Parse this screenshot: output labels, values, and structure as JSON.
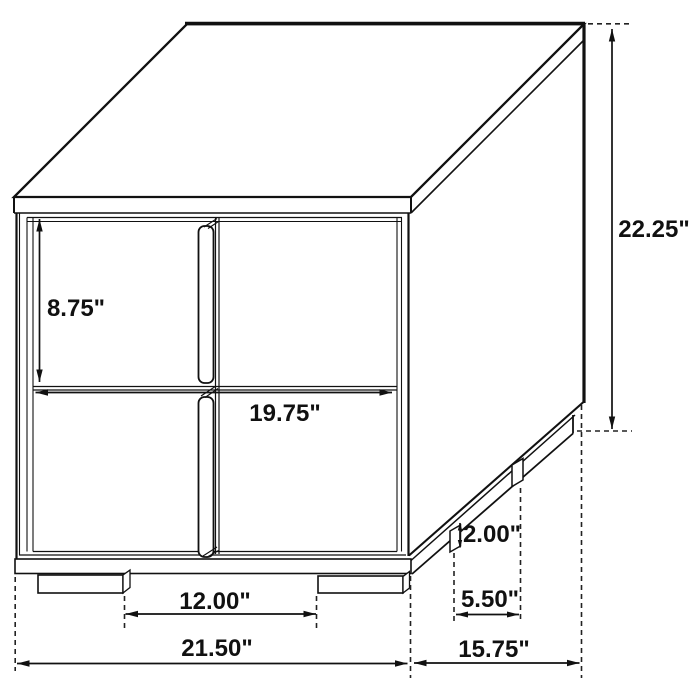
{
  "figure": {
    "type": "furniture-dimension-diagram",
    "item": "two-drawer nightstand line drawing",
    "units": "inches",
    "line_color": "#111111",
    "background_color": "#ffffff"
  },
  "dimensions": {
    "drawer_height": {
      "label": "8.75\"",
      "value": 8.75
    },
    "drawer_width": {
      "label": "19.75\"",
      "value": 19.75
    },
    "overall_height": {
      "label": "22.25\"",
      "value": 22.25
    },
    "leg_height": {
      "label": "2.00\"",
      "value": 2.0
    },
    "side_leg_spacing": {
      "label": "5.50\"",
      "value": 5.5
    },
    "front_leg_spacing": {
      "label": "12.00\"",
      "value": 12.0
    },
    "overall_width": {
      "label": "21.50\"",
      "value": 21.5
    },
    "overall_depth": {
      "label": "15.75\"",
      "value": 15.75
    }
  }
}
